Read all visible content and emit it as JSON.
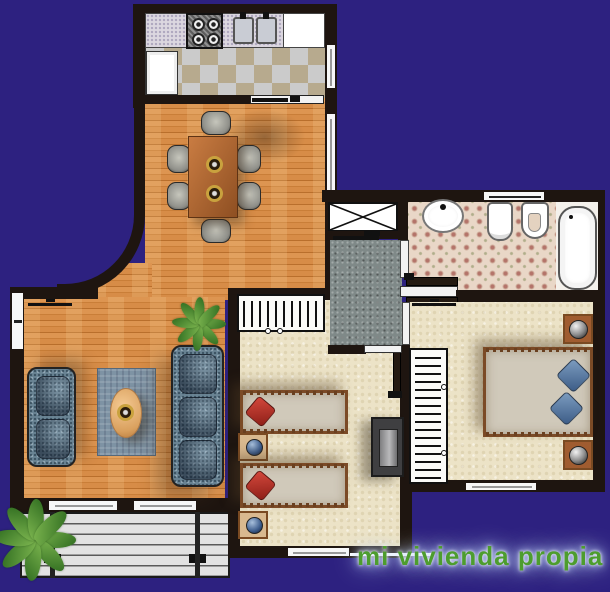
{
  "watermark": {
    "text": "mi vivienda propia",
    "color": "#4d9d2e",
    "glow": "#c3d6fa"
  },
  "colors": {
    "purple": "#2d2180",
    "wall": "#1e1510",
    "brand-green": "#4d9d2e",
    "glow": "#c3d6fa",
    "carpet": "#ece3c7",
    "tile": "#e9d7c7",
    "hall": "#7f8988",
    "terrace": "#e2e2e2",
    "sofa": "#6a8494",
    "rug": "#7e93a4",
    "mattress": "#d0c9ba",
    "bedframe": "#7b4a26"
  },
  "legend": {
    "kitchen": [
      "counter",
      "stove",
      "double-sink",
      "refrigerator",
      "checkered-floor",
      "sliding-door"
    ],
    "dining": [
      "table",
      "six-chairs",
      "window"
    ],
    "living": [
      "two-seat-sofa",
      "three-seat-sofa",
      "rug",
      "coffee-table",
      "plant",
      "windows"
    ],
    "balcony": [
      "wood-deck",
      "railing",
      "plant"
    ],
    "small-bedroom": [
      "wardrobe",
      "single-bed",
      "single-bed",
      "nightstand",
      "nightstand",
      "tv-cabinet",
      "door",
      "window"
    ],
    "master-bedroom": [
      "wardrobe",
      "double-bed",
      "nightstand",
      "nightstand",
      "sliding-door",
      "window"
    ],
    "bathroom": [
      "washbasin",
      "toilet",
      "bidet",
      "bathtub",
      "sliding-door",
      "window"
    ],
    "hall": [
      "duct-closet",
      "entry-door"
    ]
  }
}
